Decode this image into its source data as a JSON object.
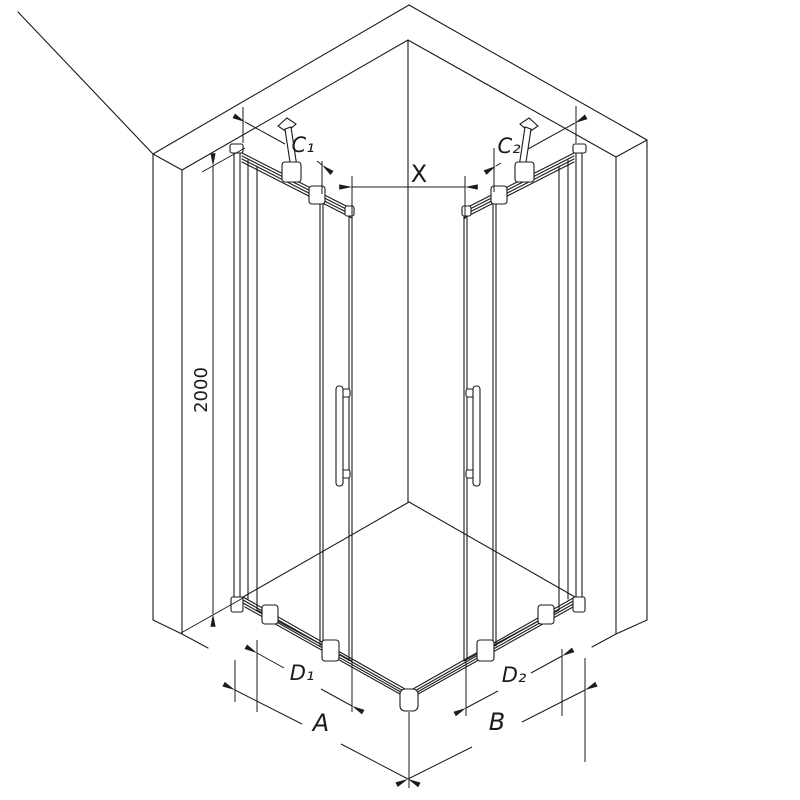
{
  "labels": {
    "c1": "C₁",
    "c2": "C₂",
    "x": "X",
    "height": "2000",
    "d1": "D₁",
    "d2": "D₂",
    "a": "A",
    "b": "B"
  },
  "colors": {
    "line": "#1b1b1b",
    "background": "#ffffff"
  }
}
